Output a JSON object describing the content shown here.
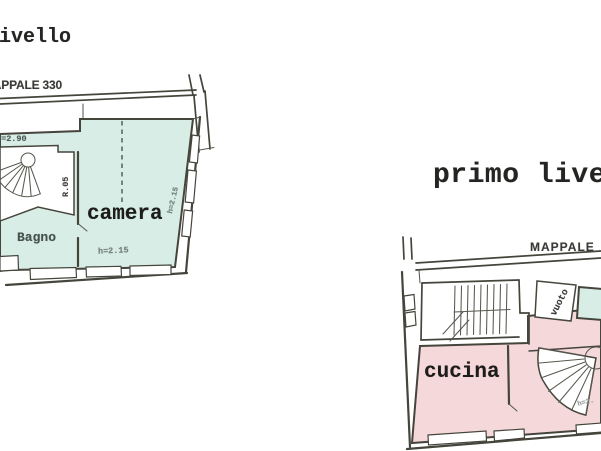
{
  "colors": {
    "teal": "#d5e9e2",
    "pink": "#f0d5d6",
    "ink": "#1e1e1c",
    "wall": "#47473f"
  },
  "left_plan": {
    "title": "livello",
    "parcel": "MAPPALE 330",
    "room_camera": "camera",
    "room_bagno": "Bagno",
    "dim_top": "h=2.90",
    "dim_stair": "R.05",
    "dim_bottom": "h=2.15",
    "dim_side": "h=2.15"
  },
  "right_plan": {
    "title": "primo livello",
    "parcel": "MAPPALE",
    "room_cucina": "cucina",
    "room_vuoto": "vuoto",
    "dim_corner": "h=2."
  }
}
